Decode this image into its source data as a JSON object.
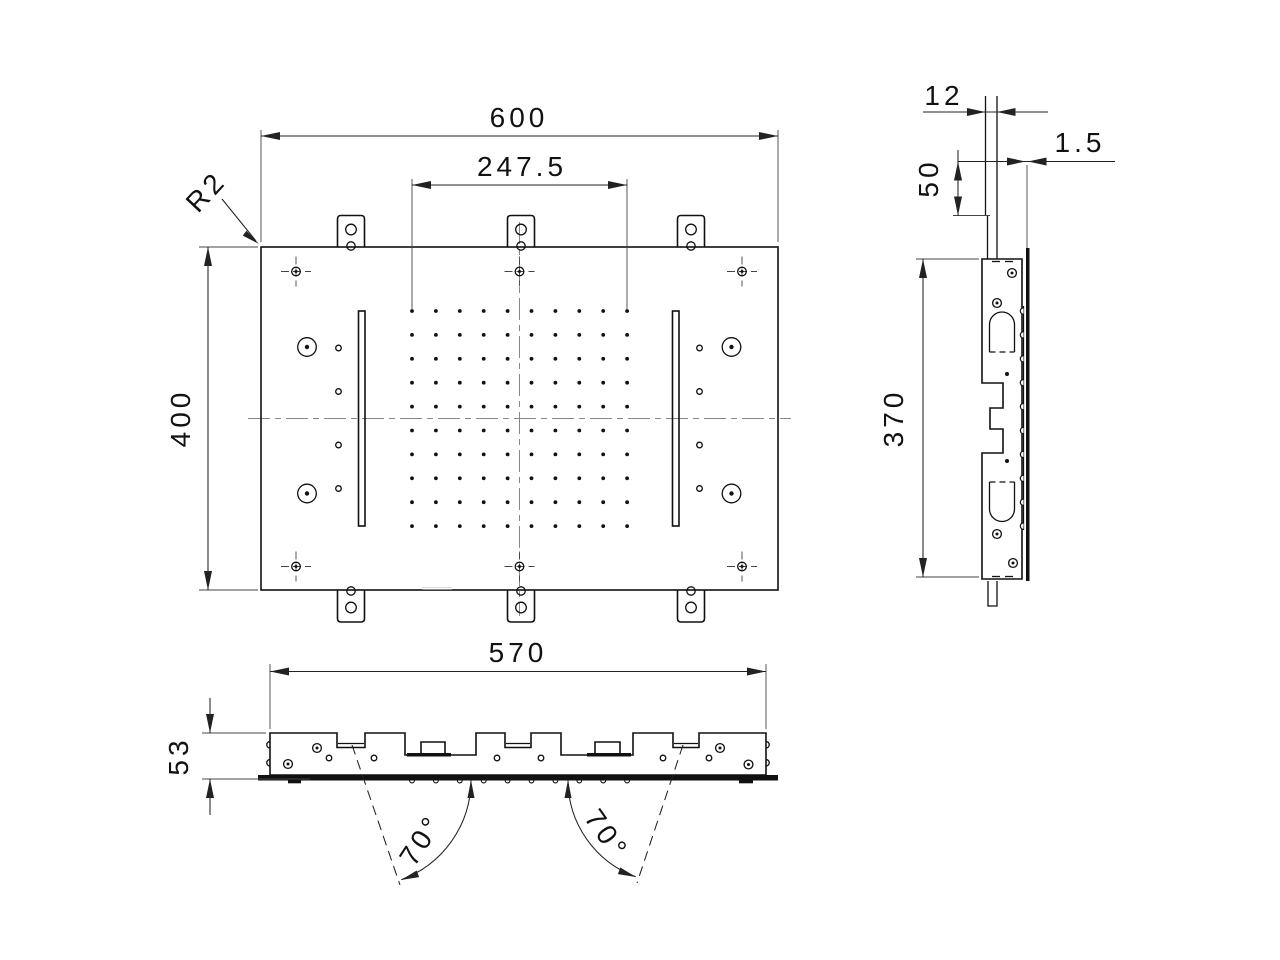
{
  "meta": {
    "type": "technical-drawing",
    "background_color": "#ffffff",
    "line_color": "#111111"
  },
  "dims": {
    "plan": {
      "width": "600",
      "grid_width": "247.5",
      "height": "400",
      "corner_radius": "R2"
    },
    "side": {
      "pipe_diameter": "12",
      "panel_thickness": "1.5",
      "pipe_length": "50",
      "body_length": "370"
    },
    "bottom": {
      "body_width": "570",
      "body_height": "53",
      "spray_angle_left": "70°",
      "spray_angle_right": "70°"
    }
  }
}
